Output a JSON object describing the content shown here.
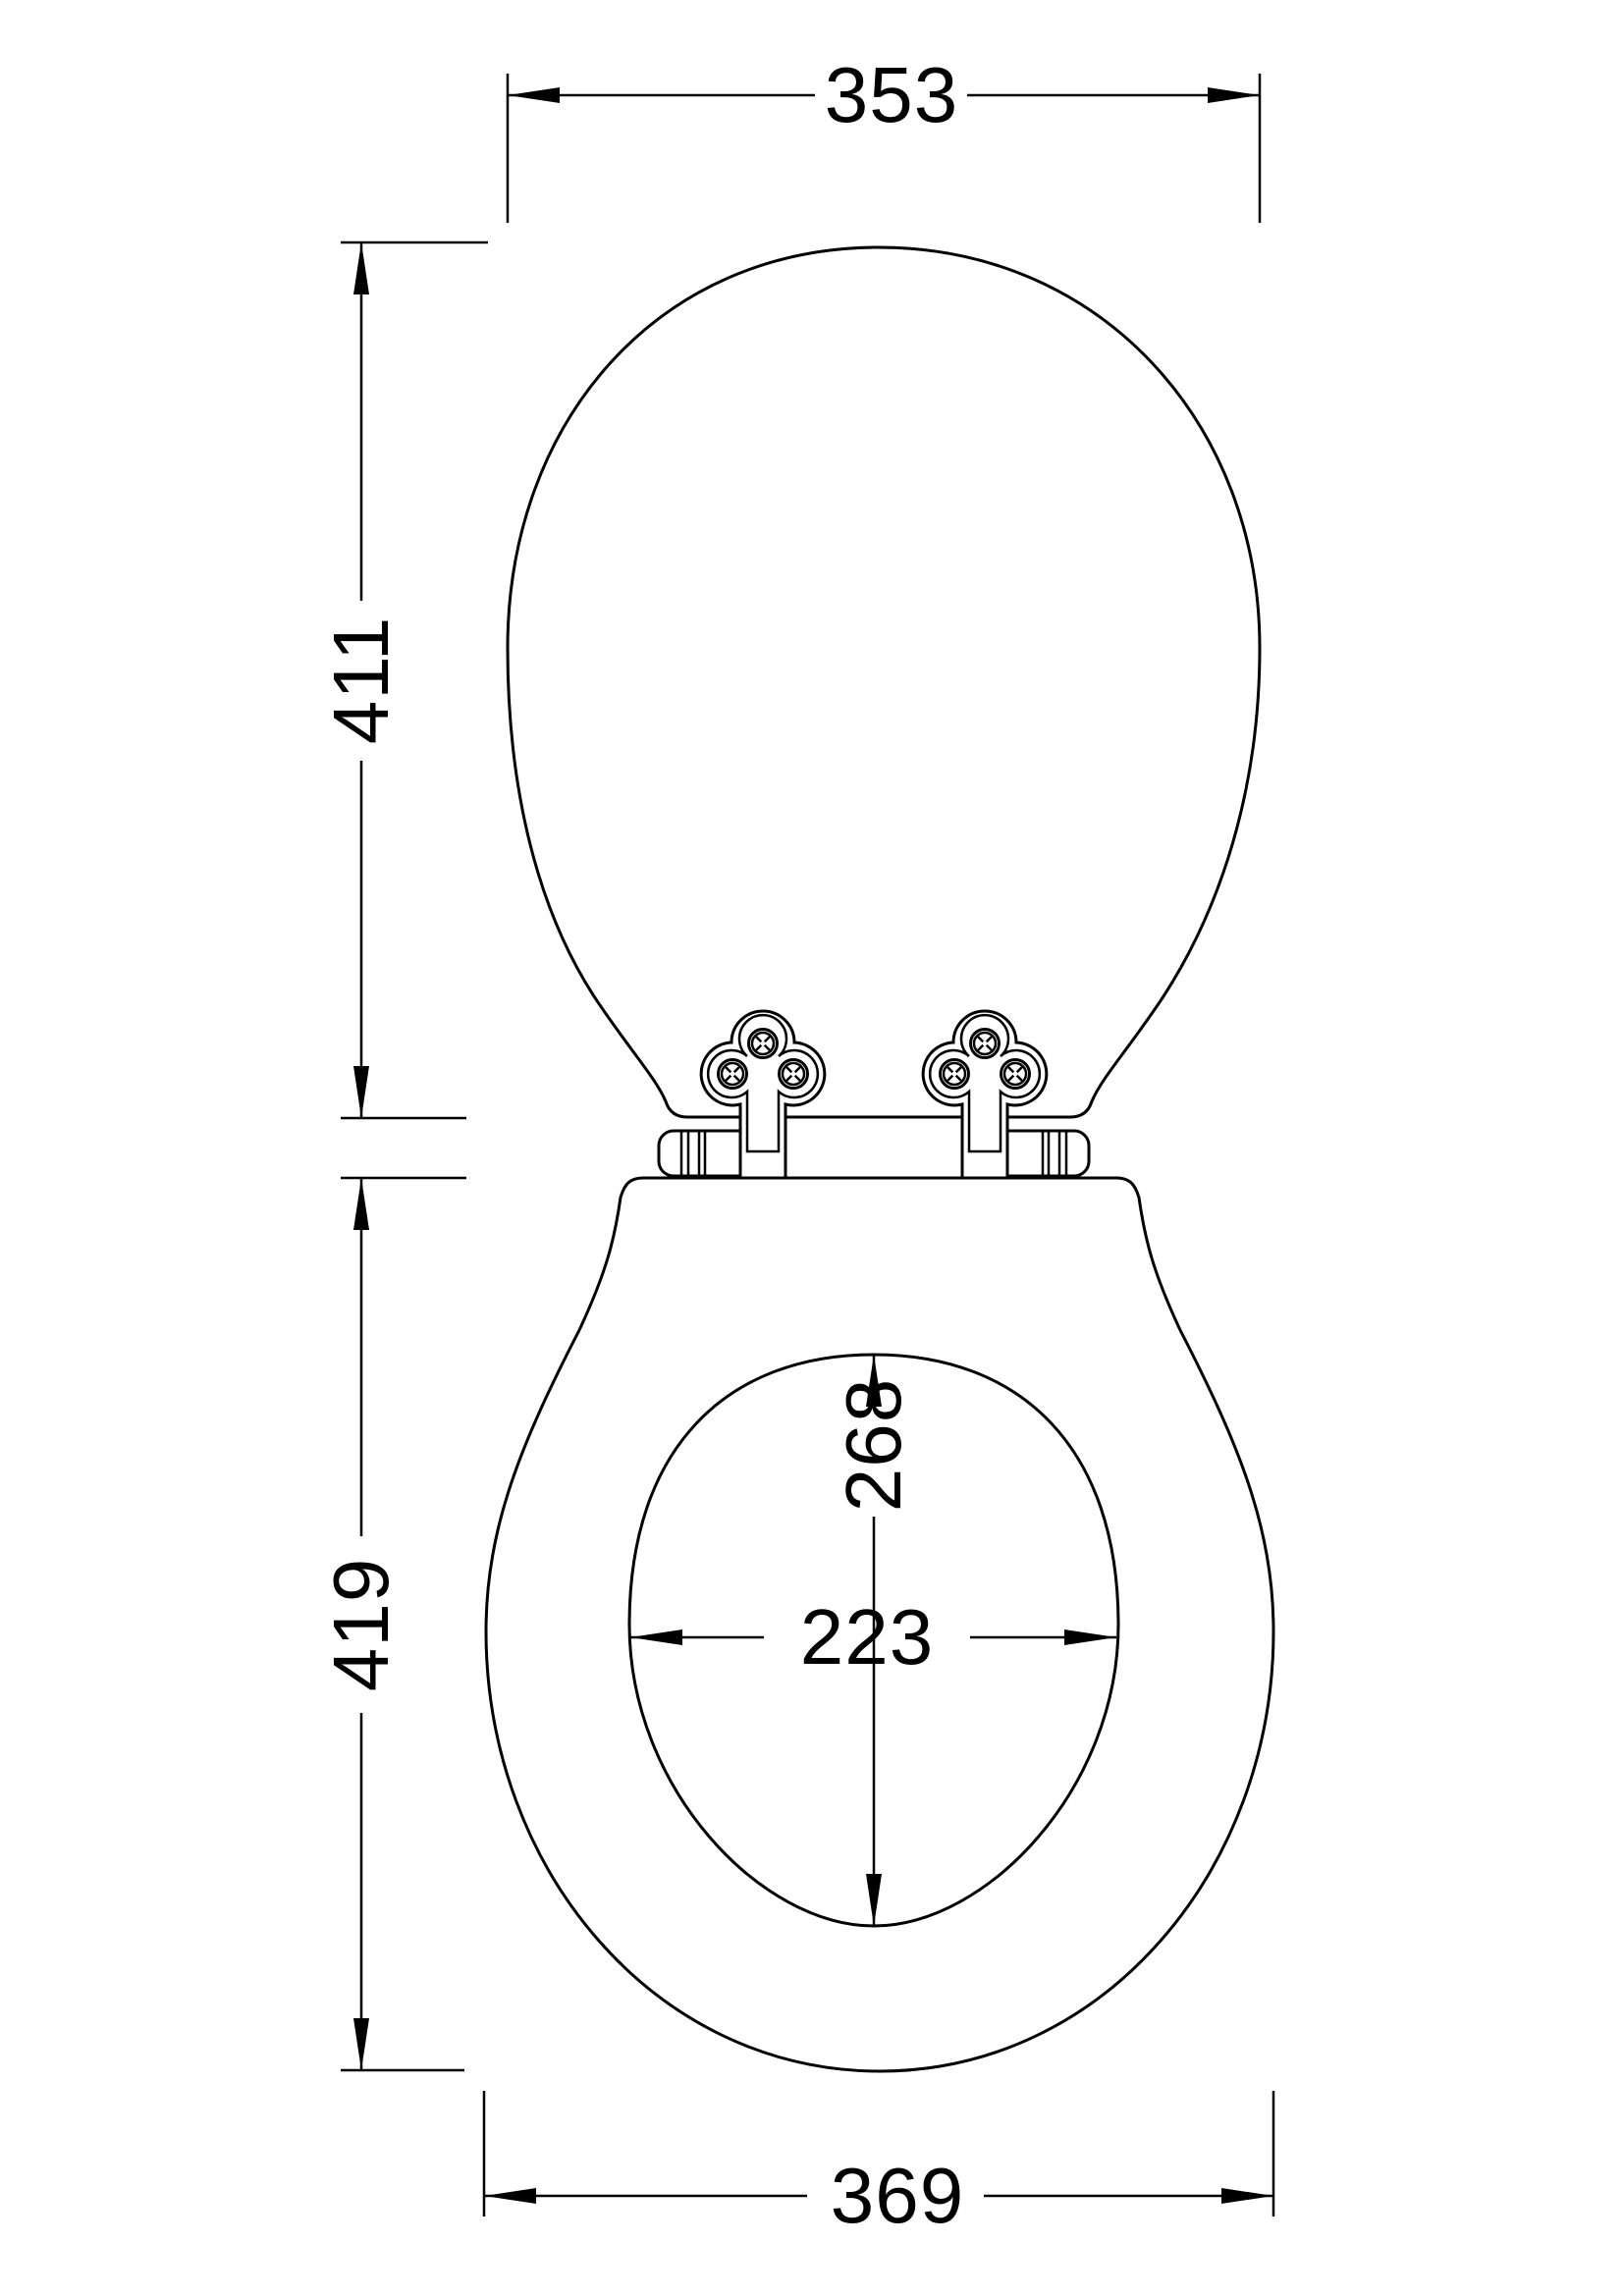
{
  "drawing": {
    "type": "technical-dimension-drawing",
    "subject": "toilet-seat-with-lid-top-view",
    "colors": {
      "line": "#000000",
      "background": "#ffffff"
    },
    "dimensions": {
      "lid_width": "353",
      "lid_length": "411",
      "seat_length": "419",
      "opening_length": "268",
      "opening_width": "223",
      "seat_width": "369"
    }
  }
}
